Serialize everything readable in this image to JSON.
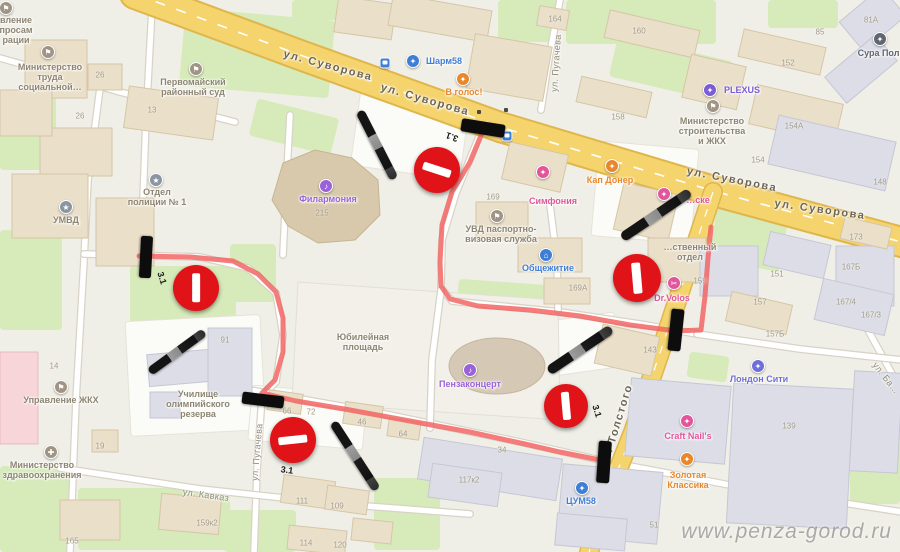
{
  "watermark": "www.penza-gorod.ru",
  "colors": {
    "route": "#f2605f",
    "no_entry_red": "#e01318",
    "road_major": "#f5d46e",
    "green": "#d7eaba",
    "poi_gray": "#8d8573",
    "poi_blue": "#3f7ed6",
    "poi_purple": "#9a62d8",
    "poi_pink": "#e3559b",
    "poi_orange": "#e8872b"
  },
  "street_labels": [
    {
      "text": "ул. Суворова",
      "x": 328,
      "y": 66,
      "rot": 15,
      "minor": false
    },
    {
      "text": "ул. Суворова",
      "x": 425,
      "y": 100,
      "rot": 16,
      "minor": false
    },
    {
      "text": "ул. Суворова",
      "x": 732,
      "y": 180,
      "rot": 11,
      "minor": false
    },
    {
      "text": "ул. Суворова",
      "x": 820,
      "y": 210,
      "rot": 8,
      "minor": false
    },
    {
      "text": "ул. Толстого",
      "x": 617,
      "y": 426,
      "rot": -73,
      "minor": false
    },
    {
      "text": "ул. Пугачева",
      "x": 257,
      "y": 452,
      "rot": -85,
      "minor": true
    },
    {
      "text": "ул. Пугачева",
      "x": 556,
      "y": 63,
      "rot": -86,
      "minor": true
    },
    {
      "text": "ул. Кавказ",
      "x": 206,
      "y": 495,
      "rot": 8,
      "minor": true
    },
    {
      "text": "ул. Ба…",
      "x": 886,
      "y": 378,
      "rot": 52,
      "minor": true
    }
  ],
  "poi": [
    {
      "name": "migration-office",
      "lines": [
        "вление",
        "просам",
        "рации"
      ],
      "color": "#8d8573",
      "icon": {
        "x": 6,
        "y": 8,
        "bg": "#a09484",
        "glyph": "⚑"
      },
      "lx": 16,
      "ly": 30
    },
    {
      "name": "mintrud",
      "lines": [
        "Министерство",
        "труда",
        "социальной…"
      ],
      "color": "#8d8573",
      "icon": {
        "x": 48,
        "y": 52,
        "bg": "#a09484",
        "glyph": "⚑"
      },
      "lx": 50,
      "ly": 77
    },
    {
      "name": "court",
      "lines": [
        "Первомайский",
        "районный суд"
      ],
      "color": "#8d8573",
      "icon": {
        "x": 196,
        "y": 69,
        "bg": "#a09484",
        "glyph": "⚑"
      },
      "lx": 193,
      "ly": 87
    },
    {
      "name": "sharm58",
      "lines": [
        "Шарм58"
      ],
      "color": "#3f7ed6",
      "icon": {
        "x": 413,
        "y": 61,
        "bg": "#3f7ed6",
        "glyph": "✦"
      },
      "lx": 444,
      "ly": 61
    },
    {
      "name": "v-golos",
      "lines": [
        "В голос!"
      ],
      "color": "#e8872b",
      "icon": {
        "x": 463,
        "y": 79,
        "bg": "#e8872b",
        "glyph": "✦"
      },
      "lx": 464,
      "ly": 92
    },
    {
      "name": "plexus",
      "lines": [
        "PLEXUS"
      ],
      "color": "#7b5bd6",
      "icon": {
        "x": 710,
        "y": 90,
        "bg": "#7b5bd6",
        "glyph": "✦"
      },
      "lx": 742,
      "ly": 90
    },
    {
      "name": "minstroy",
      "lines": [
        "Министерство",
        "строительства",
        "и ЖКХ"
      ],
      "color": "#8d8573",
      "icon": {
        "x": 713,
        "y": 106,
        "bg": "#a09484",
        "glyph": "⚑"
      },
      "lx": 712,
      "ly": 131
    },
    {
      "name": "sura",
      "lines": [
        "Сура Пол…"
      ],
      "color": "#5f6670",
      "icon": {
        "x": 880,
        "y": 39,
        "bg": "#5f6670",
        "glyph": "✦"
      },
      "lx": 883,
      "ly": 53
    },
    {
      "name": "police-dept-1",
      "lines": [
        "Отдел",
        "полиции № 1"
      ],
      "color": "#8d8573",
      "icon": {
        "x": 156,
        "y": 180,
        "bg": "#8b95a1",
        "glyph": "★"
      },
      "lx": 157,
      "ly": 197
    },
    {
      "name": "umvd",
      "lines": [
        "УМВД"
      ],
      "color": "#8d8573",
      "icon": {
        "x": 66,
        "y": 207,
        "bg": "#8b95a1",
        "glyph": "★"
      },
      "lx": 66,
      "ly": 220
    },
    {
      "name": "philharmonic",
      "lines": [
        "Филармония"
      ],
      "color": "#9a62d8",
      "icon": {
        "x": 326,
        "y": 186,
        "bg": "#9a62d8",
        "glyph": "♪"
      },
      "lx": 328,
      "ly": 199
    },
    {
      "name": "simfonia",
      "lines": [
        "Симфония"
      ],
      "color": "#e3559b",
      "icon": {
        "x": 543,
        "y": 172,
        "bg": "#e3559b",
        "glyph": "✦"
      },
      "lx": 553,
      "ly": 201
    },
    {
      "name": "kap-doner",
      "lines": [
        "Кап Донер"
      ],
      "color": "#e8872b",
      "icon": {
        "x": 612,
        "y": 166,
        "bg": "#e8872b",
        "glyph": "✦"
      },
      "lx": 610,
      "ly": 180
    },
    {
      "name": "uvd-passport",
      "lines": [
        "УВД паспортно-",
        "визовая служба"
      ],
      "color": "#8d8573",
      "icon": {
        "x": 497,
        "y": 216,
        "bg": "#a09484",
        "glyph": "⚑"
      },
      "lx": 501,
      "ly": 234
    },
    {
      "name": "obshchezhitie",
      "lines": [
        "Общежитие"
      ],
      "color": "#3f7ed6",
      "icon": {
        "x": 546,
        "y": 255,
        "bg": "#3f7ed6",
        "glyph": "⌂"
      },
      "lx": 548,
      "ly": 268
    },
    {
      "name": "otdel",
      "lines": [
        "…ственный",
        "отдел"
      ],
      "color": "#8d8573",
      "icon": null,
      "lx": 690,
      "ly": 252
    },
    {
      "name": "ske",
      "lines": [
        "…ске"
      ],
      "color": "#e3559b",
      "icon": {
        "x": 664,
        "y": 194,
        "bg": "#e3559b",
        "glyph": "✦"
      },
      "lx": 698,
      "ly": 200
    },
    {
      "name": "dr-volos",
      "lines": [
        "Dr.Volos"
      ],
      "color": "#e3559b",
      "icon": {
        "x": 674,
        "y": 283,
        "bg": "#e3559b",
        "glyph": "✂"
      },
      "lx": 672,
      "ly": 298
    },
    {
      "name": "yubileynaya-square",
      "lines": [
        "Юбилейная",
        "площадь"
      ],
      "color": "#8d8573",
      "icon": null,
      "lx": 363,
      "ly": 342
    },
    {
      "name": "penzaconcert",
      "lines": [
        "Пензаконцерт"
      ],
      "color": "#9a62d8",
      "icon": {
        "x": 470,
        "y": 370,
        "bg": "#9a62d8",
        "glyph": "♪"
      },
      "lx": 470,
      "ly": 384
    },
    {
      "name": "uzhkh",
      "lines": [
        "Управление ЖКХ"
      ],
      "color": "#8d8573",
      "icon": {
        "x": 61,
        "y": 387,
        "bg": "#a09484",
        "glyph": "⚑"
      },
      "lx": 61,
      "ly": 400
    },
    {
      "name": "minzdrav",
      "lines": [
        "Министерство",
        "здравоохранения"
      ],
      "color": "#8d8573",
      "icon": {
        "x": 51,
        "y": 452,
        "bg": "#a09484",
        "glyph": "✚"
      },
      "lx": 42,
      "ly": 470
    },
    {
      "name": "olympic-school",
      "lines": [
        "Училище",
        "олимпийского",
        "резерва"
      ],
      "color": "#8d8573",
      "icon": null,
      "lx": 198,
      "ly": 404
    },
    {
      "name": "tsum58",
      "lines": [
        "ЦУМ58"
      ],
      "color": "#3f7ed6",
      "icon": {
        "x": 582,
        "y": 488,
        "bg": "#3f7ed6",
        "glyph": "✦"
      },
      "lx": 581,
      "ly": 501
    },
    {
      "name": "craft-nails",
      "lines": [
        "Craft Nail's"
      ],
      "color": "#e3559b",
      "icon": {
        "x": 687,
        "y": 421,
        "bg": "#e3559b",
        "glyph": "✦"
      },
      "lx": 688,
      "ly": 436
    },
    {
      "name": "zolotaya-klassika",
      "lines": [
        "Золотая",
        "Классика"
      ],
      "color": "#e8872b",
      "icon": {
        "x": 687,
        "y": 459,
        "bg": "#e8872b",
        "glyph": "✦"
      },
      "lx": 688,
      "ly": 480
    },
    {
      "name": "london-city",
      "lines": [
        "Лондон Сити"
      ],
      "color": "#6f6fd8",
      "icon": {
        "x": 758,
        "y": 366,
        "bg": "#6f6fd8",
        "glyph": "✦"
      },
      "lx": 759,
      "ly": 379
    }
  ],
  "numbers": [
    {
      "t": "26",
      "x": 100,
      "y": 76
    },
    {
      "t": "26",
      "x": 80,
      "y": 117
    },
    {
      "t": "13",
      "x": 152,
      "y": 111
    },
    {
      "t": "164",
      "x": 555,
      "y": 20
    },
    {
      "t": "160",
      "x": 639,
      "y": 32
    },
    {
      "t": "152",
      "x": 788,
      "y": 64
    },
    {
      "t": "158",
      "x": 618,
      "y": 118
    },
    {
      "t": "154А",
      "x": 794,
      "y": 127
    },
    {
      "t": "154",
      "x": 758,
      "y": 161
    },
    {
      "t": "148",
      "x": 880,
      "y": 183
    },
    {
      "t": "173",
      "x": 856,
      "y": 238
    },
    {
      "t": "167Б",
      "x": 851,
      "y": 268
    },
    {
      "t": "151",
      "x": 777,
      "y": 275
    },
    {
      "t": "157",
      "x": 760,
      "y": 303
    },
    {
      "t": "167/4",
      "x": 846,
      "y": 303
    },
    {
      "t": "167/3",
      "x": 871,
      "y": 316
    },
    {
      "t": "157Б",
      "x": 775,
      "y": 335
    },
    {
      "t": "143",
      "x": 650,
      "y": 351
    },
    {
      "t": "139",
      "x": 789,
      "y": 427
    },
    {
      "t": "169",
      "x": 493,
      "y": 198
    },
    {
      "t": "169А",
      "x": 578,
      "y": 289
    },
    {
      "t": "215",
      "x": 322,
      "y": 214
    },
    {
      "t": "91",
      "x": 225,
      "y": 341
    },
    {
      "t": "14",
      "x": 54,
      "y": 367
    },
    {
      "t": "19",
      "x": 100,
      "y": 447
    },
    {
      "t": "165",
      "x": 72,
      "y": 542
    },
    {
      "t": "159к2",
      "x": 207,
      "y": 524
    },
    {
      "t": "159",
      "x": 700,
      "y": 282
    },
    {
      "t": "66",
      "x": 287,
      "y": 412
    },
    {
      "t": "72",
      "x": 311,
      "y": 413
    },
    {
      "t": "46",
      "x": 362,
      "y": 423
    },
    {
      "t": "64",
      "x": 403,
      "y": 435
    },
    {
      "t": "34",
      "x": 502,
      "y": 451
    },
    {
      "t": "117к2",
      "x": 469,
      "y": 481
    },
    {
      "t": "111",
      "x": 302,
      "y": 502
    },
    {
      "t": "109",
      "x": 337,
      "y": 507
    },
    {
      "t": "114",
      "x": 306,
      "y": 544
    },
    {
      "t": "120",
      "x": 340,
      "y": 546
    },
    {
      "t": "51",
      "x": 654,
      "y": 526
    },
    {
      "t": "85",
      "x": 820,
      "y": 33
    },
    {
      "t": "81А",
      "x": 871,
      "y": 21
    }
  ],
  "bus_stops": [
    [
      385,
      63
    ],
    [
      507,
      136
    ]
  ],
  "traffic_lights": [
    [
      479,
      112
    ],
    [
      506,
      110
    ]
  ],
  "overlay": {
    "route_color": "#f2605f",
    "routes": [
      {
        "points": [
          [
            482,
            133
          ],
          [
            470,
            162
          ],
          [
            452,
            192
          ],
          [
            442,
            225
          ],
          [
            440,
            262
          ],
          [
            441,
            286
          ],
          [
            450,
            299
          ],
          [
            478,
            306
          ],
          [
            530,
            310
          ],
          [
            580,
            316
          ],
          [
            630,
            325
          ],
          [
            676,
            331
          ],
          [
            701,
            330
          ],
          [
            705,
            296
          ],
          [
            708,
            258
          ],
          [
            711,
            227
          ]
        ]
      },
      {
        "points": [
          [
            139,
            256
          ],
          [
            190,
            257
          ],
          [
            233,
            261
          ],
          [
            258,
            274
          ],
          [
            276,
            292
          ],
          [
            283,
            318
          ],
          [
            283,
            352
          ],
          [
            275,
            380
          ],
          [
            262,
            393
          ],
          [
            296,
            401
          ],
          [
            350,
            410
          ],
          [
            410,
            421
          ],
          [
            470,
            432
          ],
          [
            525,
            444
          ],
          [
            560,
            452
          ],
          [
            600,
            460
          ]
        ]
      }
    ],
    "no_entry_signs": [
      {
        "cx": 437,
        "cy": 170,
        "r": 23,
        "bar_rot": 18
      },
      {
        "cx": 196,
        "cy": 288,
        "r": 23,
        "bar_rot": 90
      },
      {
        "cx": 637,
        "cy": 278,
        "r": 24,
        "bar_rot": 85
      },
      {
        "cx": 293,
        "cy": 440,
        "r": 23,
        "bar_rot": -6
      },
      {
        "cx": 566,
        "cy": 406,
        "r": 22,
        "bar_rot": 85
      }
    ],
    "closure_bars": [
      {
        "cx": 483,
        "cy": 128,
        "len": 44,
        "th": 13,
        "rot": 9
      },
      {
        "cx": 146,
        "cy": 257,
        "len": 42,
        "th": 12,
        "rot": 93
      },
      {
        "cx": 676,
        "cy": 330,
        "len": 42,
        "th": 13,
        "rot": 96
      },
      {
        "cx": 604,
        "cy": 462,
        "len": 42,
        "th": 13,
        "rot": 94
      },
      {
        "cx": 263,
        "cy": 400,
        "len": 42,
        "th": 12,
        "rot": 7
      }
    ],
    "batons": [
      {
        "cx": 377,
        "cy": 145,
        "len": 76,
        "th": 9,
        "rot": 63
      },
      {
        "cx": 656,
        "cy": 215,
        "len": 82,
        "th": 10,
        "rot": -34
      },
      {
        "cx": 580,
        "cy": 350,
        "len": 76,
        "th": 10,
        "rot": -34
      },
      {
        "cx": 177,
        "cy": 352,
        "len": 68,
        "th": 9,
        "rot": -36
      },
      {
        "cx": 355,
        "cy": 456,
        "len": 80,
        "th": 9,
        "rot": 57
      }
    ],
    "sign_codes": [
      {
        "text": "3.1",
        "x": 452,
        "y": 137,
        "rot": 200
      },
      {
        "text": "3.1",
        "x": 162,
        "y": 278,
        "rot": 72
      },
      {
        "text": "3.1",
        "x": 597,
        "y": 411,
        "rot": 72
      },
      {
        "text": "3.1",
        "x": 287,
        "y": 470,
        "rot": 8
      }
    ]
  }
}
